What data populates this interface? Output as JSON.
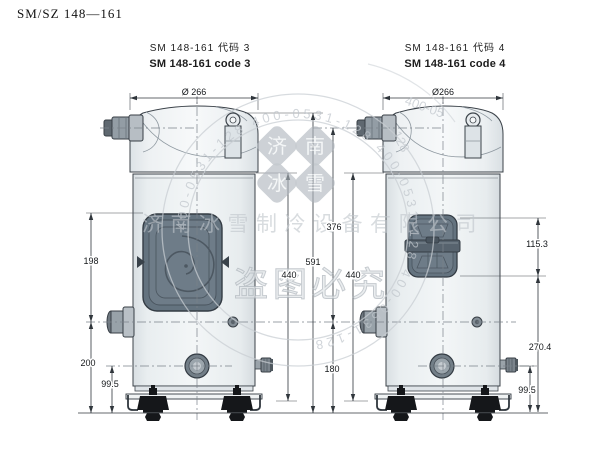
{
  "page": {
    "title": "SM/SZ 148—161"
  },
  "left_view": {
    "header_cn": "SM 148-161 代码 3",
    "header_en": "SM 148-161 code 3",
    "dims": {
      "diameter": "Ø 266",
      "box_top": "198",
      "discharge_to_base": "200",
      "sight_glass": "99.5",
      "shell": "440"
    }
  },
  "middle_dims": {
    "total_height": "591",
    "suction_to_discharge": "376",
    "discharge_to_base": "180"
  },
  "right_view": {
    "header_cn": "SM 148-161 代码 4",
    "header_en": "SM 148-161 code 4",
    "dims": {
      "diameter": "Ø266",
      "terminal_box": "115.3",
      "box_to_base": "270.4",
      "valve_height": "99.5",
      "shell": "440"
    }
  },
  "watermark": {
    "seal_chars": [
      "济",
      "南",
      "冰",
      "雪"
    ],
    "company": "济南冰雪制冷设备有限公司",
    "phone_ring": "400-0531-128  400-0531-128  400-0531-128  400-0531-128",
    "phone_top": "400-05",
    "phone_side": "128",
    "warning": "盗图必究"
  }
}
